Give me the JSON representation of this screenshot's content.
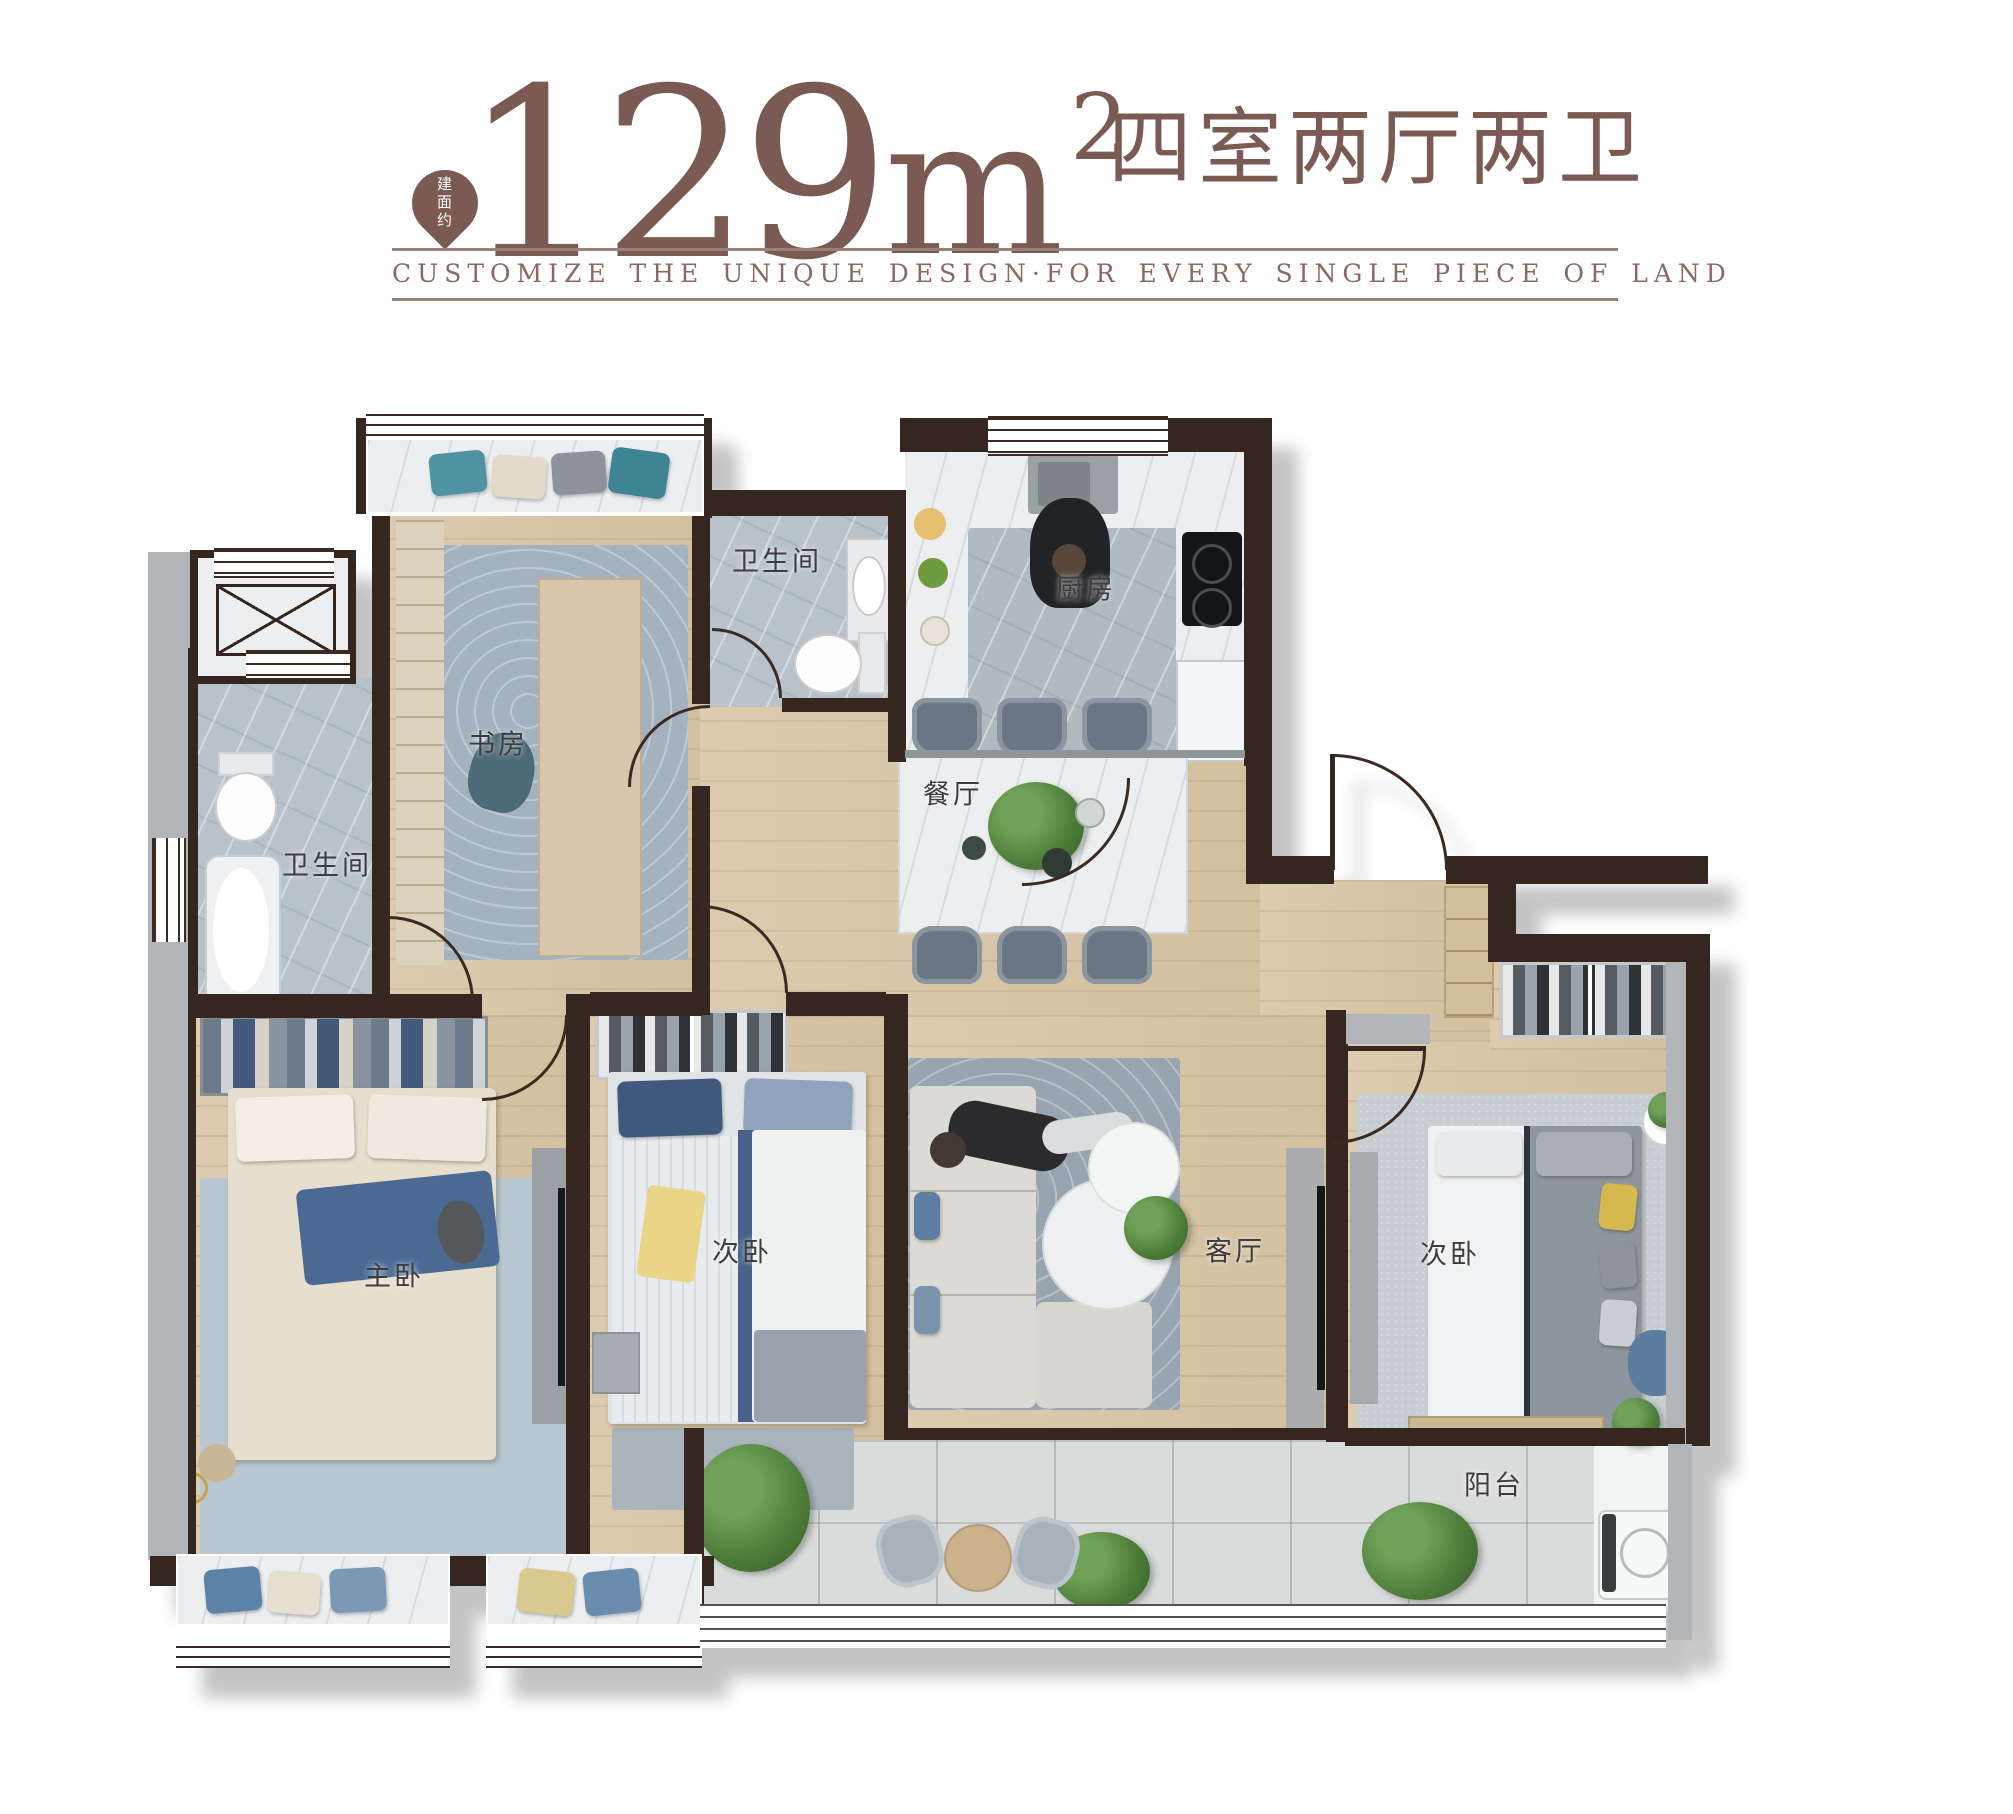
{
  "header": {
    "badge_text": "建面约",
    "area_number": "129",
    "area_unit": "m",
    "area_exponent": "2",
    "layout_title": "四室两厅两卫",
    "tagline": "CUSTOMIZE THE UNIQUE DESIGN·FOR EVERY SINGLE PIECE OF LAND",
    "accent_color": "#7a5a52"
  },
  "floorplan": {
    "rooms": {
      "study": {
        "label": "书房"
      },
      "bath_top": {
        "label": "卫生间"
      },
      "kitchen": {
        "label": "厨房"
      },
      "dining": {
        "label": "餐厅"
      },
      "bath_left": {
        "label": "卫生间"
      },
      "master_bedroom": {
        "label": "主卧"
      },
      "bedroom_middle": {
        "label": "次卧"
      },
      "living_room": {
        "label": "客厅"
      },
      "bedroom_right": {
        "label": "次卧"
      },
      "balcony": {
        "label": "阳台"
      }
    },
    "palette": {
      "wall": "#35261f",
      "wood_floor": "#d9c8aa",
      "bath_tile": "#b7c2ca",
      "balcony_tile": "#dadcdb",
      "accent_teal": "#4f93a3",
      "accent_blue": "#47618a",
      "accent_yellow": "#e9d488"
    }
  }
}
